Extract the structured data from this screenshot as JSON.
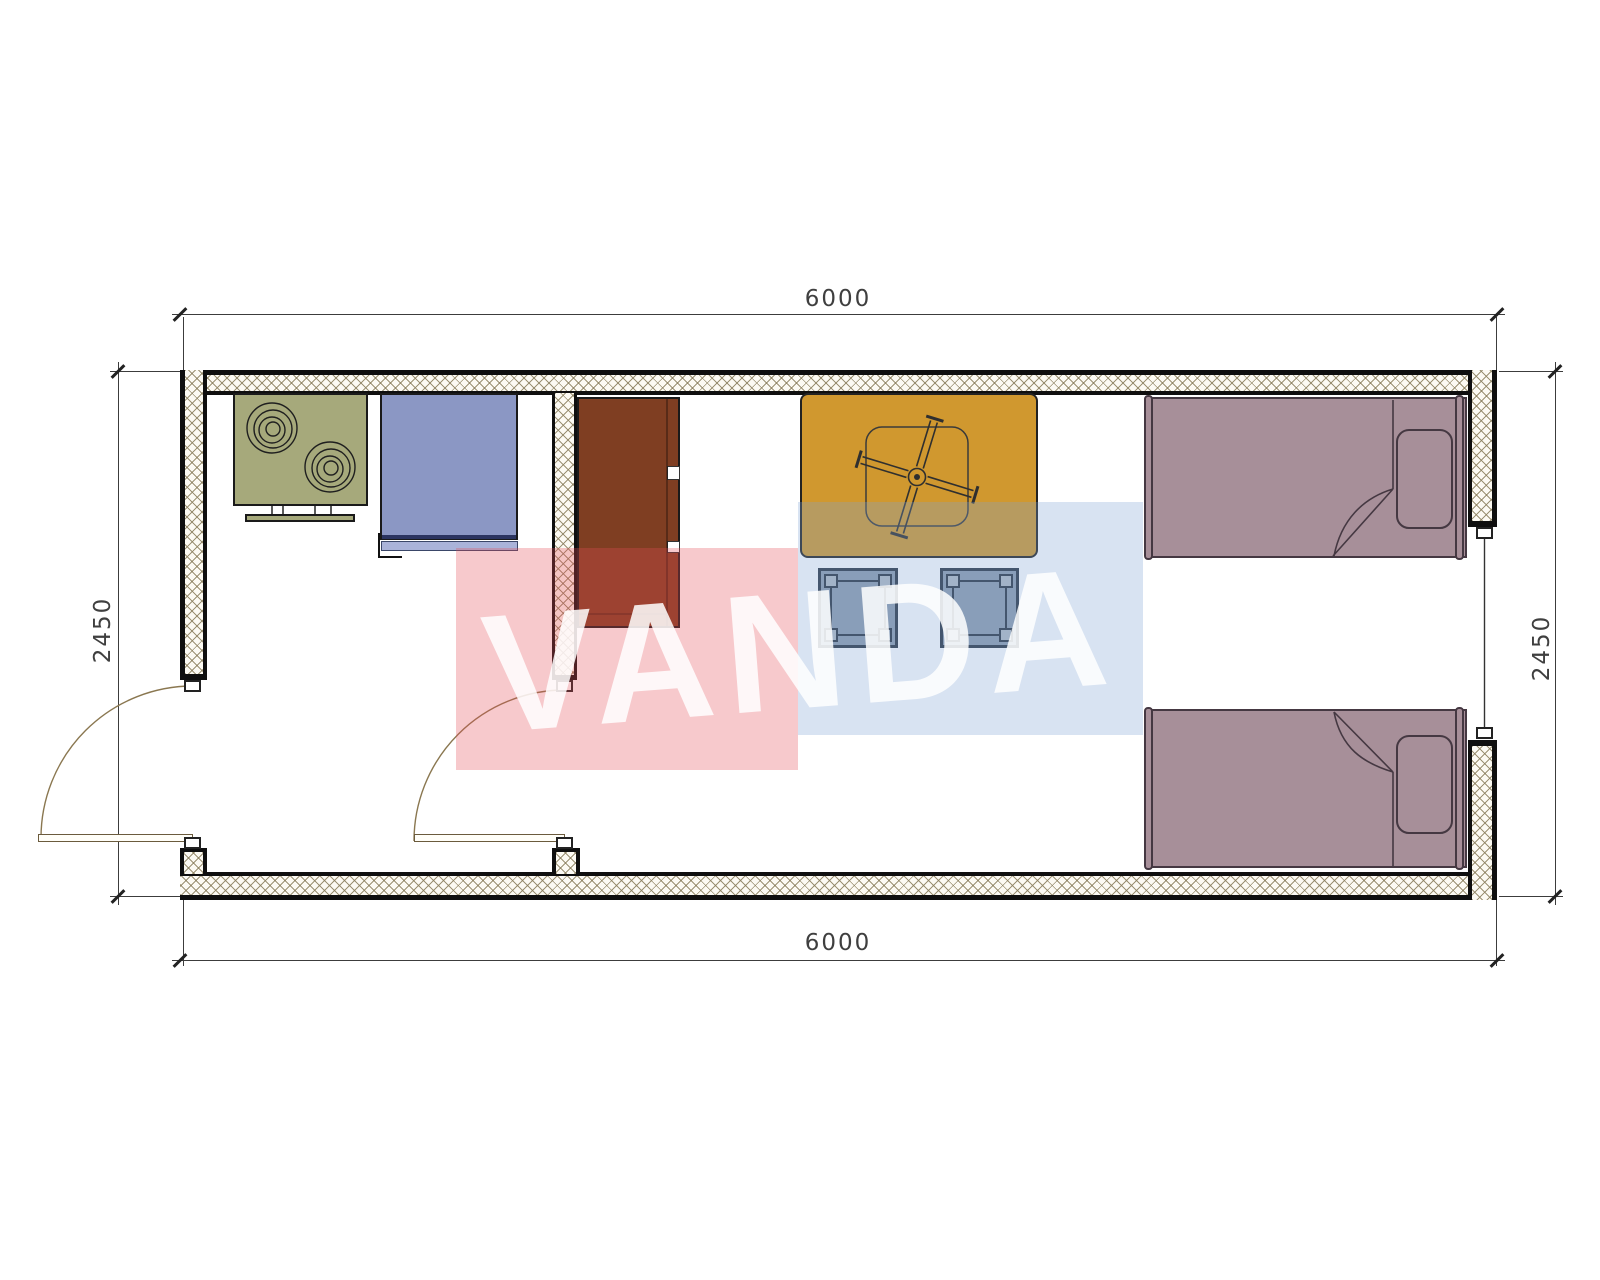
{
  "page": {
    "kind": "architectural-floor-plan",
    "background": "#ffffff"
  },
  "dimensions": {
    "top": "6000",
    "bottom": "6000",
    "left": "2450",
    "right": "2450"
  },
  "watermark": {
    "text": "VANDA"
  },
  "colors": {
    "stove": "#a6a97b",
    "appliance": "#8b97c4",
    "appliance_line": "#2b3460",
    "appliance_tray": "#aab3d9",
    "cabinet": "#7f3e22",
    "table": "#d0982f",
    "stool": "#8e9cae",
    "stool_foot": "#b2bac3",
    "bed": "#a78f99",
    "wm_red": "rgba(228,75,85,0.30)",
    "wm_blue": "rgba(125,162,212,0.30)",
    "wm_text": "rgba(255,255,255,0.85)",
    "wall_hatch": "#8b7f5e",
    "door_arc": "#8a7750",
    "dim_text": "#3f3f3f"
  },
  "items": [
    {
      "name": "cooktop-stove-symbol",
      "room": "kitchen"
    },
    {
      "name": "kitchen-appliance-symbol",
      "room": "kitchen"
    },
    {
      "name": "wardrobe-cabinet-symbol",
      "room": "living-bedroom"
    },
    {
      "name": "table-with-ceiling-fan-symbol",
      "room": "living-bedroom"
    },
    {
      "name": "stool-symbol",
      "count": 2
    },
    {
      "name": "single-bed-symbol",
      "count": 2
    },
    {
      "name": "entry-door-swing",
      "wall": "left"
    },
    {
      "name": "interior-door-swing",
      "wall": "partition"
    },
    {
      "name": "window-symbol",
      "wall": "right"
    }
  ]
}
